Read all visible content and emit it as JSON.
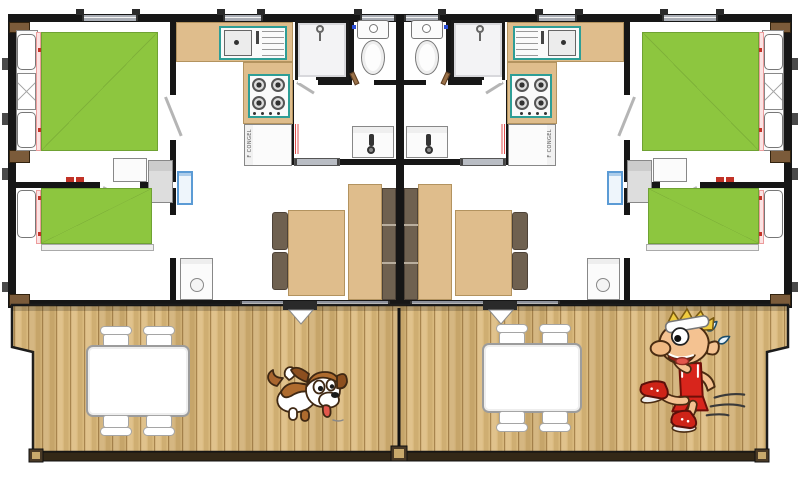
{
  "title": "Semi-detached chalet floor plan with shared wooden terrace",
  "units": {
    "count": 2,
    "arrangement": "mirrored around central party wall",
    "rooms_per_unit": [
      "double-bedroom",
      "twin-bedroom",
      "kitchen",
      "shower-room",
      "wc",
      "vanity-bathroom",
      "dining-area"
    ]
  },
  "labels": {
    "fridge": "F CONGEL"
  },
  "icons": [
    "shower-head-icon",
    "toilet-icon",
    "tap-icon",
    "stove-burner-icon",
    "sink-drain-icon",
    "water-heater-icon",
    "door-swing-icon"
  ],
  "deck": {
    "tables": [
      {
        "side": "left",
        "chairs": 4
      },
      {
        "side": "right",
        "chairs": 4
      }
    ],
    "characters": [
      {
        "name": "puppy-dog",
        "side": "left"
      },
      {
        "name": "running-elf",
        "side": "right"
      }
    ]
  },
  "colors": {
    "bed_green": "#8DC63F",
    "mattress_border": "#6FA233",
    "wood_tan": "#DFBD8C",
    "wood_tan_border": "#B3935F",
    "bench_brown": "#6F6150",
    "wall_black": "#161616",
    "window_gray": "#A9ADB5",
    "appliance_teal": "#2E9E96",
    "heater_blue": "#5B9BD5",
    "pink_trim": "#EC9C9C",
    "red_accent": "#D23B2C",
    "deck_light": "#E0C28C",
    "deck_mid": "#D2B175",
    "deck_dark": "#A8854E",
    "rail_brown": "#3B2F1D",
    "post_brown": "#7B5B3A"
  }
}
